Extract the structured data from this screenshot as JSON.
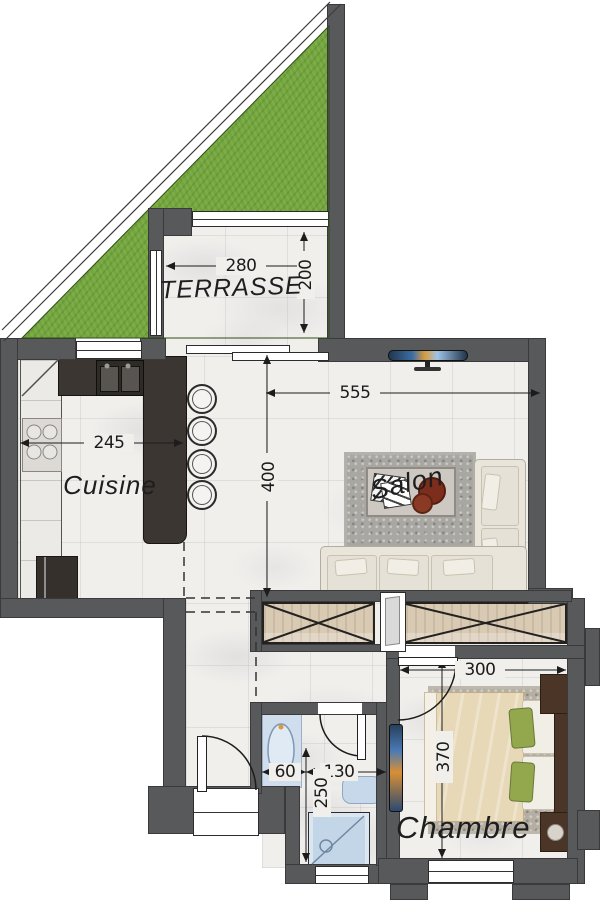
{
  "rooms": {
    "terrasse": {
      "label": "TERRASSE",
      "width_cm": "280",
      "depth_cm": "200"
    },
    "cuisine": {
      "label": "Cuisine",
      "width_cm": "245"
    },
    "salon": {
      "label": "Salon",
      "width_cm": "555",
      "depth_cm": "400"
    },
    "chambre": {
      "label": "Chambre",
      "width_cm": "300",
      "depth_cm": "370"
    },
    "salle_deau": {
      "basin_cm": "60",
      "wc_cm": "130",
      "depth_cm": "250"
    }
  },
  "palette": {
    "wall": "#58595b",
    "grass": "#74a63d",
    "floor": "#f1efec",
    "kitchen_counter": "#3b3632",
    "closet_wood": "#d9cab4",
    "sofa": "#e9e5da",
    "rug": "#a8a7a2",
    "bed_duvet": "#e7d9b7",
    "dark_wood": "#4a3526",
    "sanitary_blue": "#c6d8ea",
    "line": "#1c1c1c"
  }
}
